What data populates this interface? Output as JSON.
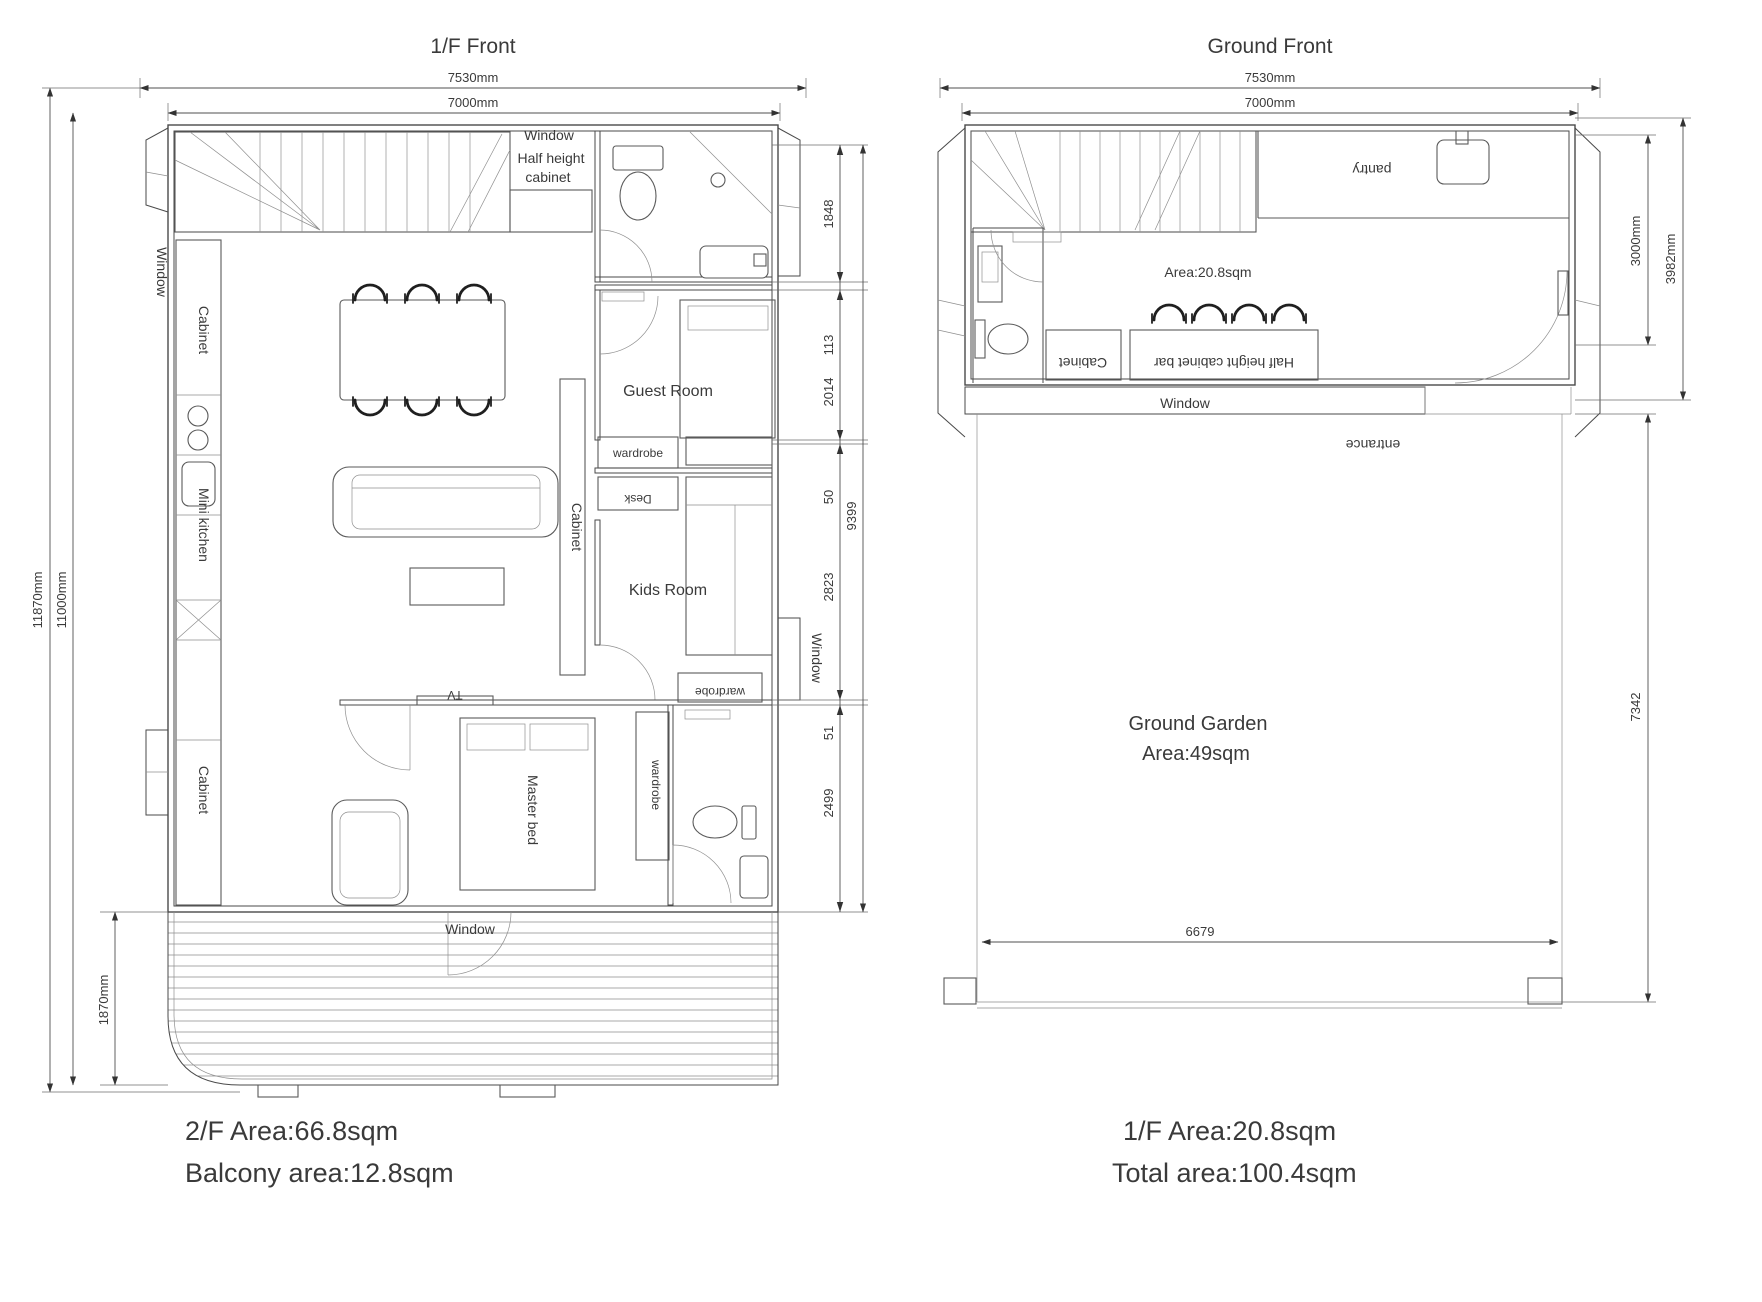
{
  "colors": {
    "background": "#ffffff",
    "line": "#4a4a4a",
    "dim_line": "#4f4f4f",
    "text": "#3a3a3a"
  },
  "left_plan": {
    "title": "1/F Front",
    "dims": {
      "outer_width": "7530mm",
      "inner_width": "7000mm",
      "total_height": "11870mm",
      "main_height": "11000mm",
      "balcony_depth": "1870mm",
      "chain": [
        "1848",
        "113",
        "2014",
        "50",
        "2823",
        "51",
        "2499"
      ],
      "chain_total": "9399"
    },
    "labels": {
      "window_top": "Window",
      "half_height_1": "Half height",
      "half_height_2": "cabinet",
      "window_left": "Window",
      "cabinet_left_top": "Cabinet",
      "mini_kitchen": "Mini kitchen",
      "cabinet_left_bottom": "Cabinet",
      "cabinet_mid": "Cabinet",
      "guest_room": "Guest Room",
      "wardrobe_guest": "wardrobe",
      "desk": "Desk",
      "kids_room": "Kids Room",
      "wardrobe_kids": "wardrobe",
      "window_right": "Window",
      "tv": "TV",
      "master_bed": "Master bed",
      "wardrobe_master": "wardrobe",
      "window_bottom": "Window"
    },
    "notes": [
      "2/F Area:66.8sqm",
      "Balcony area:12.8sqm"
    ]
  },
  "right_plan": {
    "title": "Ground Front",
    "dims": {
      "outer_width": "7530mm",
      "inner_width": "7000mm",
      "interior_depth": "3000mm",
      "building_depth": "3982mm",
      "garden_width": "6679",
      "garden_depth": "7342"
    },
    "labels": {
      "pantry": "pantry",
      "area": "Area:20.8sqm",
      "cabinet": "Cabinet",
      "bar": "Half height cabinet bar",
      "window": "Window",
      "entrance": "entrance",
      "garden_title": "Ground Garden",
      "garden_area": "Area:49sqm"
    },
    "notes": [
      "1/F Area:20.8sqm",
      "Total area:100.4sqm"
    ]
  }
}
